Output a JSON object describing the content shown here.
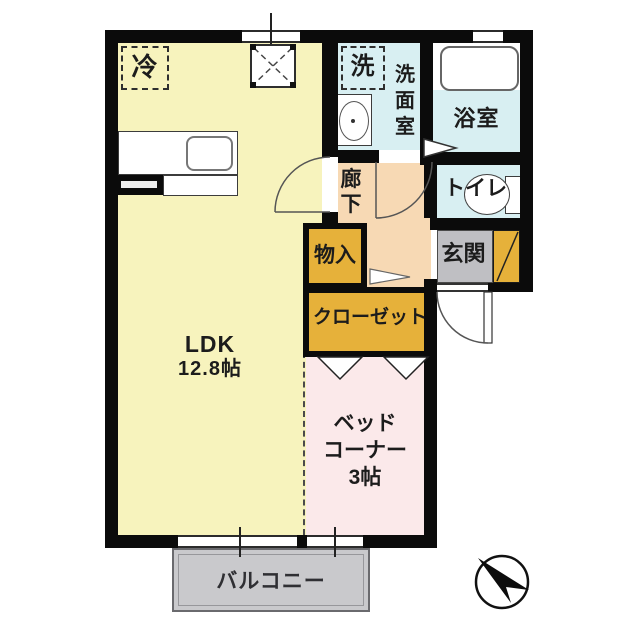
{
  "floorplan": {
    "ldk": {
      "name": "LDK",
      "size": "12.8帖"
    },
    "bed_corner": {
      "line1": "ベッド",
      "line2": "コーナー",
      "size": "3帖"
    },
    "washroom": {
      "c0": "洗",
      "c1": "面",
      "c2": "室"
    },
    "bathroom": {
      "label": "浴室"
    },
    "toilet": {
      "label": "トイレ"
    },
    "hallway": {
      "c0": "廊",
      "c1": "下"
    },
    "entrance": {
      "label": "玄関"
    },
    "storage": {
      "label": "物入"
    },
    "closet": {
      "label": "クローゼット"
    },
    "balcony": {
      "label": "バルコニー"
    },
    "refrigerator": {
      "label": "冷"
    },
    "washer": {
      "label": "洗"
    },
    "compass": {
      "arrow_direction": "north-west"
    },
    "colors": {
      "wall": "#0b0b0b",
      "ldk": "#f7f3bd",
      "wet_rooms": "#d8eff2",
      "hallway": "#f7d9b4",
      "storage": "#e6b13a",
      "entrance_floor": "#bfbfc3",
      "bed_corner": "#fbe9ea",
      "balcony": "#c9c9cc"
    }
  }
}
